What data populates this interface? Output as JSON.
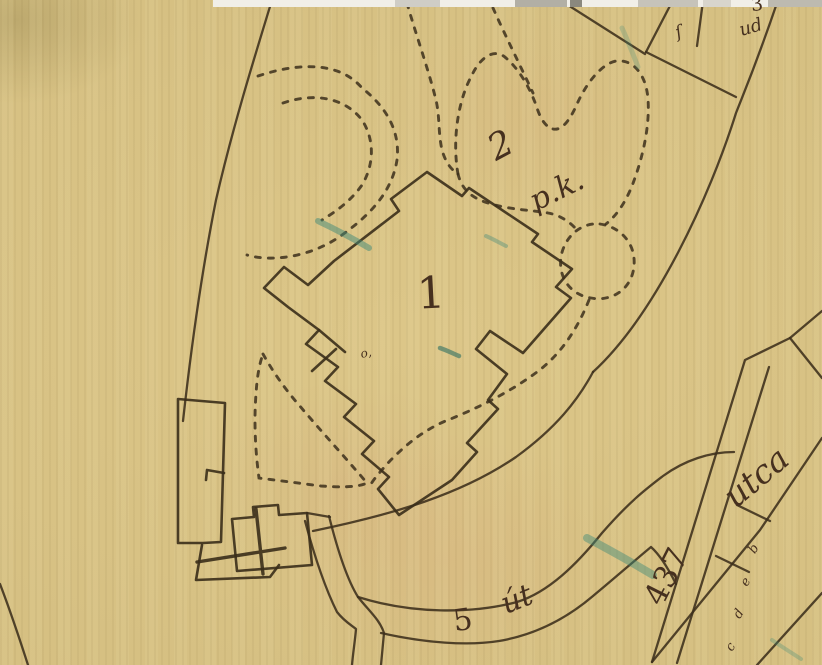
{
  "map": {
    "kind": "historical-cadastral-map-scan",
    "colors": {
      "paper": "#dcc688",
      "ink": "#3c2f1b",
      "label_ink": "#46301f",
      "pencil_teal": "#3f8a78",
      "scan_strip": "#f1efe8"
    },
    "labels": [
      {
        "id": "parcel-1",
        "text": "1",
        "x": 431,
        "y": 294,
        "size": 44,
        "rot": -3,
        "style": "serif"
      },
      {
        "id": "parcel-2",
        "text": "2",
        "x": 501,
        "y": 146,
        "size": 36,
        "rot": -28,
        "style": "script"
      },
      {
        "id": "parcel-2-pk",
        "text": "p.k.",
        "x": 557,
        "y": 191,
        "size": 30,
        "rot": -26,
        "style": "script"
      },
      {
        "id": "road-5",
        "text": "5",
        "x": 463,
        "y": 621,
        "size": 30,
        "rot": -8,
        "style": "serif"
      },
      {
        "id": "road-ut",
        "text": "út",
        "x": 517,
        "y": 600,
        "size": 30,
        "rot": -22,
        "style": "script"
      },
      {
        "id": "street-437",
        "text": "437",
        "x": 667,
        "y": 577,
        "size": 31,
        "rot": -63,
        "style": "serif"
      },
      {
        "id": "street-utca",
        "text": "utca",
        "x": 756,
        "y": 477,
        "size": 33,
        "rot": -40,
        "style": "script"
      },
      {
        "id": "parcel-3",
        "text": "3",
        "x": 757,
        "y": 5,
        "size": 19,
        "rot": -8,
        "style": "serif"
      },
      {
        "id": "parcel-ud",
        "text": "ud",
        "x": 751,
        "y": 28,
        "size": 18,
        "rot": -16,
        "style": "script"
      },
      {
        "id": "mark-long-s",
        "text": "ſ",
        "x": 679,
        "y": 33,
        "size": 17,
        "rot": -18,
        "style": "script"
      },
      {
        "id": "mark-o",
        "text": "o,",
        "x": 366,
        "y": 353,
        "size": 12,
        "rot": -12,
        "style": "script"
      },
      {
        "id": "tiny-b",
        "text": "b",
        "x": 754,
        "y": 549,
        "size": 13,
        "rot": -58,
        "style": "script"
      },
      {
        "id": "tiny-e",
        "text": "e",
        "x": 746,
        "y": 582,
        "size": 13,
        "rot": -58,
        "style": "script"
      },
      {
        "id": "tiny-d",
        "text": "d",
        "x": 739,
        "y": 614,
        "size": 13,
        "rot": -58,
        "style": "script"
      },
      {
        "id": "tiny-c",
        "text": "c",
        "x": 731,
        "y": 647,
        "size": 13,
        "rot": -58,
        "style": "script"
      }
    ]
  }
}
